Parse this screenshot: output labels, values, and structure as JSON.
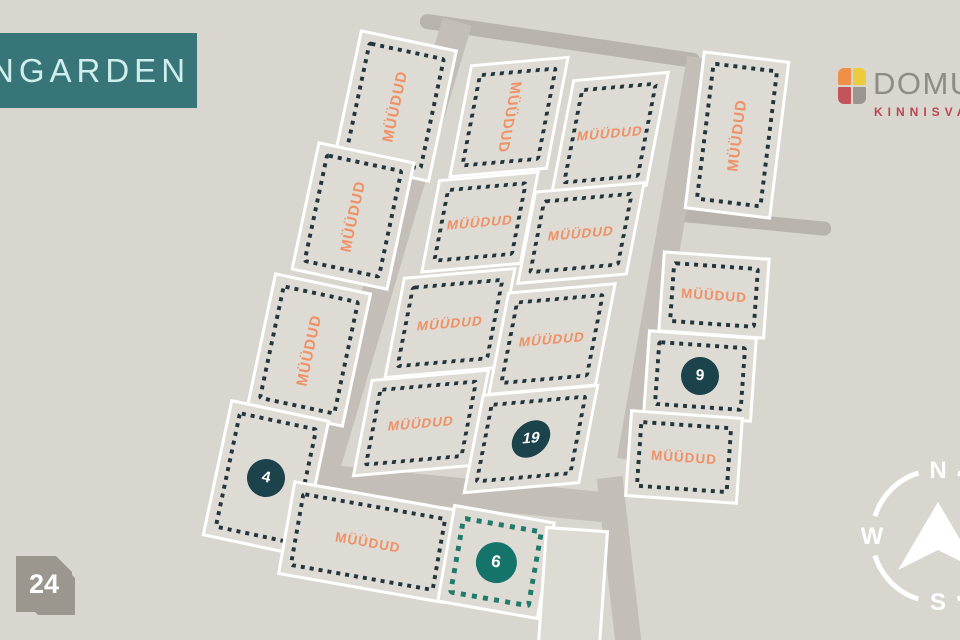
{
  "branding": {
    "estate_logo": {
      "text": "ANGARDEN"
    },
    "agency_logo": {
      "name": "DOMUS",
      "subtitle": "KINNISVARA",
      "tiles": [
        "tile-orange",
        "tile-yellow",
        "tile-red",
        "tile-gray"
      ]
    }
  },
  "badge": {
    "number": "24"
  },
  "compass": {
    "north": "N",
    "west": "W",
    "south": "S"
  },
  "plots": [
    {
      "id": "L1",
      "status": "sold",
      "label": "MÜÜDUD"
    },
    {
      "id": "L2",
      "status": "sold",
      "label": "MÜÜDUD"
    },
    {
      "id": "L3",
      "status": "sold",
      "label": "MÜÜDUD"
    },
    {
      "id": "L4",
      "status": "available",
      "number": "4"
    },
    {
      "id": "B1",
      "status": "sold",
      "label": "MÜÜDUD"
    },
    {
      "id": "B2",
      "status": "available",
      "number": "6",
      "highlighted": true
    },
    {
      "id": "B3",
      "status": "unmarked"
    },
    {
      "id": "C11",
      "status": "sold",
      "label": "MÜÜDUD"
    },
    {
      "id": "C12",
      "status": "sold",
      "label": "MÜÜDUD"
    },
    {
      "id": "C21",
      "status": "sold",
      "label": "MÜÜDUD"
    },
    {
      "id": "C22",
      "status": "sold",
      "label": "MÜÜDUD"
    },
    {
      "id": "C31",
      "status": "sold",
      "label": "MÜÜDUD"
    },
    {
      "id": "C32",
      "status": "sold",
      "label": "MÜÜDUD"
    },
    {
      "id": "C41",
      "status": "sold",
      "label": "MÜÜDUD"
    },
    {
      "id": "C42",
      "status": "available",
      "number": "19"
    },
    {
      "id": "R0",
      "status": "sold",
      "label": "MÜÜDUD"
    },
    {
      "id": "R1",
      "status": "sold",
      "label": "MÜÜDUD"
    },
    {
      "id": "R2",
      "status": "available",
      "number": "9"
    },
    {
      "id": "R3",
      "status": "sold",
      "label": "MÜÜDUD"
    }
  ],
  "colors": {
    "bg": "#d9d6cf",
    "plot_fill": "#dedbd4",
    "white": "#ffffff",
    "road": "#c3bfb8",
    "road_dark": "#b8b4ad",
    "dash_navy": "#21363e",
    "dash_green": "#217a6b",
    "circle_navy": "#1c424c",
    "circle_green": "#15746a",
    "sold_orange": "#ef9166",
    "logo_teal": "#377578",
    "logo_text": "#cfeeec",
    "domus_gray": "#8e8a85",
    "domus_red": "#b9474e",
    "tile_orange": "#ee9048",
    "tile_yellow": "#eccb3f",
    "tile_red": "#c4545c",
    "tile_gray": "#9a968f",
    "badge_gray": "#9b968e",
    "compass_white": "#ffffff"
  }
}
